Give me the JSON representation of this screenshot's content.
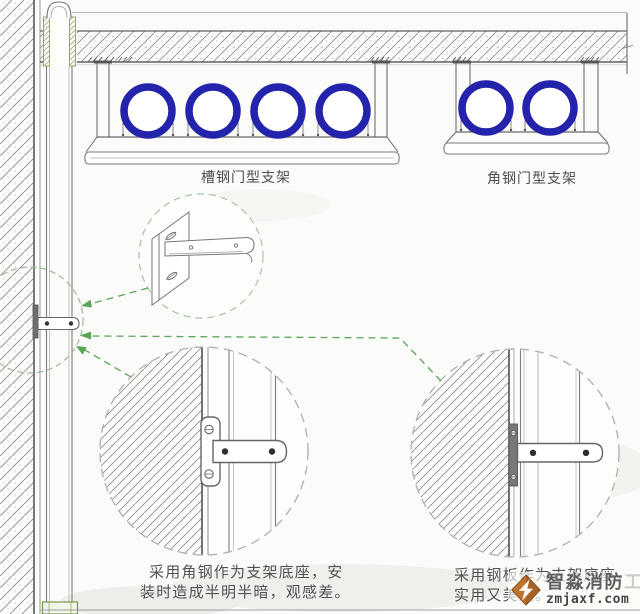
{
  "labels": {
    "channel_bracket": "槽钢门型支架",
    "angle_bracket": "角钢门型支架"
  },
  "notes": {
    "left_line1": "采用角钢作为支架底座，安",
    "left_line2": "装时造成半明半暗，观感差。",
    "right_line1": "采用钢板作为支架底座，",
    "right_line2": "实用又美观。"
  },
  "watermark": {
    "brand": "智淼消防",
    "brand_suffix": "工程",
    "url": "zmjaxf.com"
  },
  "colors": {
    "pipe_ring": "#2323ab",
    "leader_green": "#5aa55a",
    "logo_orange": "#c0752e",
    "line_gray": "#666666",
    "sleeve_green": "#8aa04e"
  }
}
